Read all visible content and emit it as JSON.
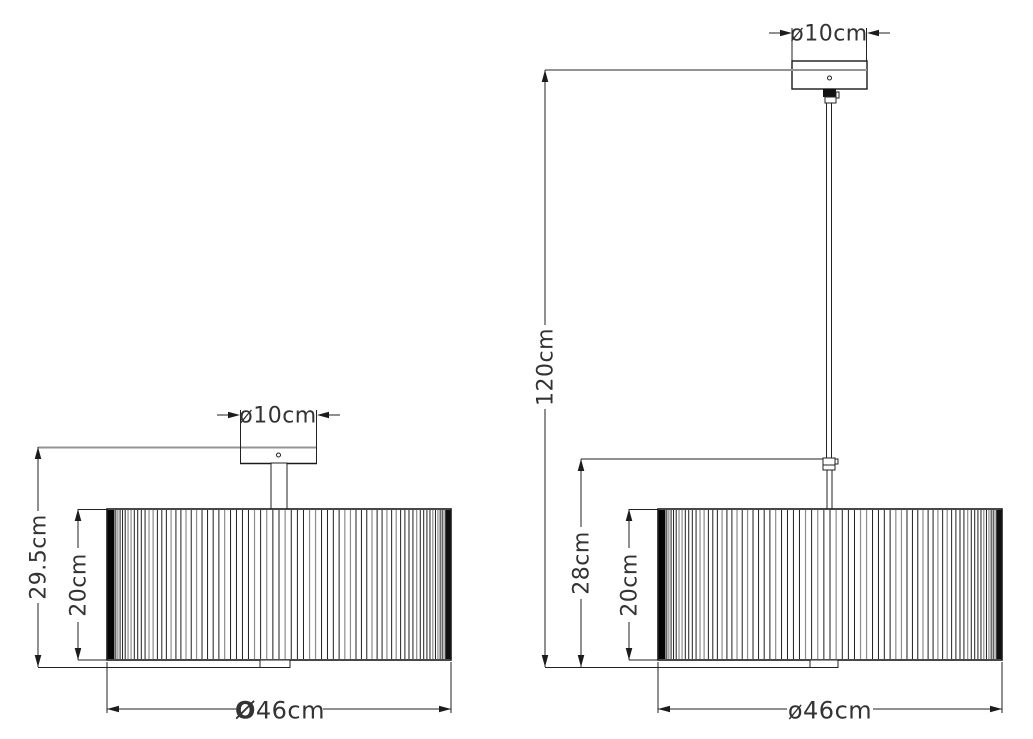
{
  "left_view": {
    "canopy_diameter": "ø10cm",
    "total_height": "29.5cm",
    "shade_height": "20cm",
    "shade_diameter_symbol": "Ø",
    "shade_diameter_value": "46cm"
  },
  "right_view": {
    "canopy_diameter": "ø10cm",
    "suspension_height": "120cm",
    "min_drop": "28cm",
    "shade_height": "20cm",
    "shade_diameter": "ø46cm"
  },
  "colors": {
    "line": "#1f1f1f",
    "extension_line": "#949494",
    "text": "#333333",
    "background": "#ffffff"
  }
}
